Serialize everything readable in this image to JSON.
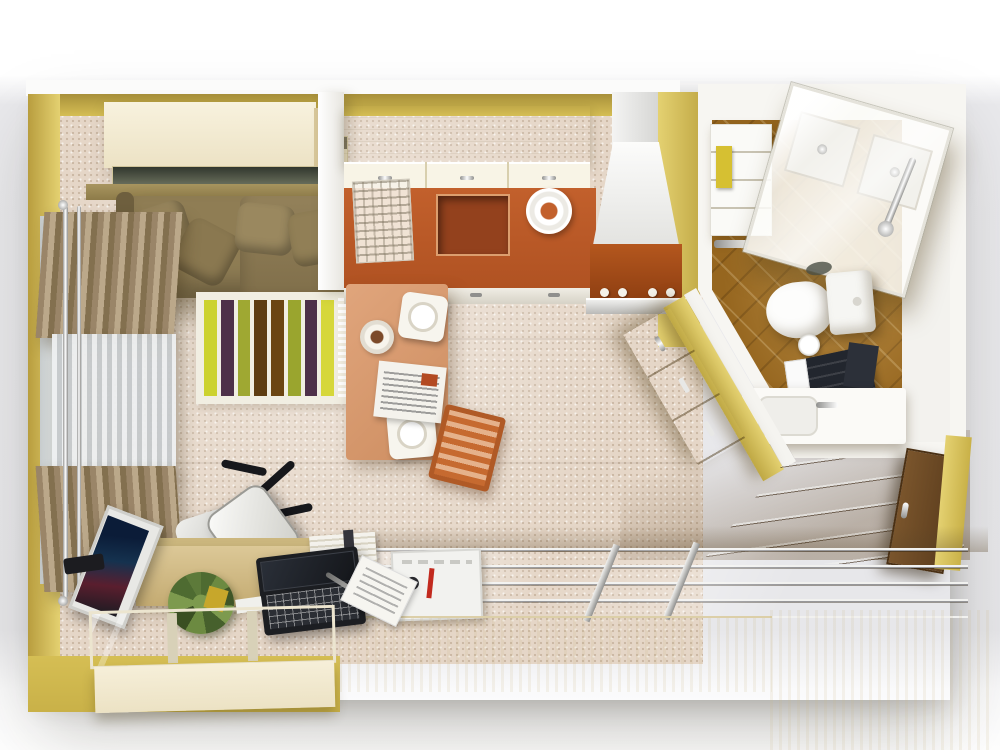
{
  "title": "3D top-down studio apartment floor plan render",
  "palette": {
    "wall_yellow": "#d5be54",
    "wall_yellow_light": "#e4d171",
    "wall_white": "#f7f6f2",
    "carpet": "#e5d6c7",
    "cream": "#ece2c4",
    "sofa_olive": "#8f7d54",
    "counter_orange": "#c2602c",
    "counter_orange_light": "#e0a57c",
    "stove_orange": "#b4571e",
    "stool_orange": "#c66a30",
    "bath_tile": "#96661f",
    "wood_desk": "#dcc897",
    "wood_cabinet": "#c2a363",
    "door_wood": "#5c3d1d",
    "rug_base": "#f1eee2",
    "towel_yellow": "#d6c032",
    "black": "#22262e"
  },
  "rug": {
    "stripes": [
      "#ccd22f",
      "#4e3049",
      "#9fa832",
      "#5e3d12",
      "#6b4512",
      "#9aa52e",
      "#4e3049",
      "#d6d73a"
    ]
  },
  "scene": {
    "rooms": [
      {
        "name": "living-area",
        "furniture": [
          "wall cabinet",
          "glass shelf",
          "olive sofa with cushions",
          "curtain rod",
          "brown curtains",
          "sheer curtain",
          "striped rug"
        ]
      },
      {
        "name": "kitchen",
        "furniture": [
          "upper cabinets",
          "orange countertop",
          "sink",
          "dish rack",
          "cooker hood",
          "stove",
          "oven",
          "breakfast peninsula",
          "wooden stool",
          "plates",
          "cup",
          "newspaper"
        ]
      },
      {
        "name": "bathroom",
        "furniture": [
          "glass shower cabin",
          "shower trays",
          "shower column",
          "toilet",
          "flush plate",
          "vanity sink",
          "towel shelf",
          "yellow towel",
          "black towels",
          "toilet paper"
        ]
      },
      {
        "name": "home-office",
        "furniture": [
          "office chair",
          "desk",
          "laptop",
          "monitor",
          "plant",
          "desk lamp",
          "papers",
          "books",
          "glass-top cabinet"
        ]
      },
      {
        "name": "hallway",
        "furniture": [
          "sliding-door wardrobe",
          "door tracks",
          "storage organizer",
          "entry door",
          "wood cabinet on angled wall"
        ]
      }
    ]
  }
}
